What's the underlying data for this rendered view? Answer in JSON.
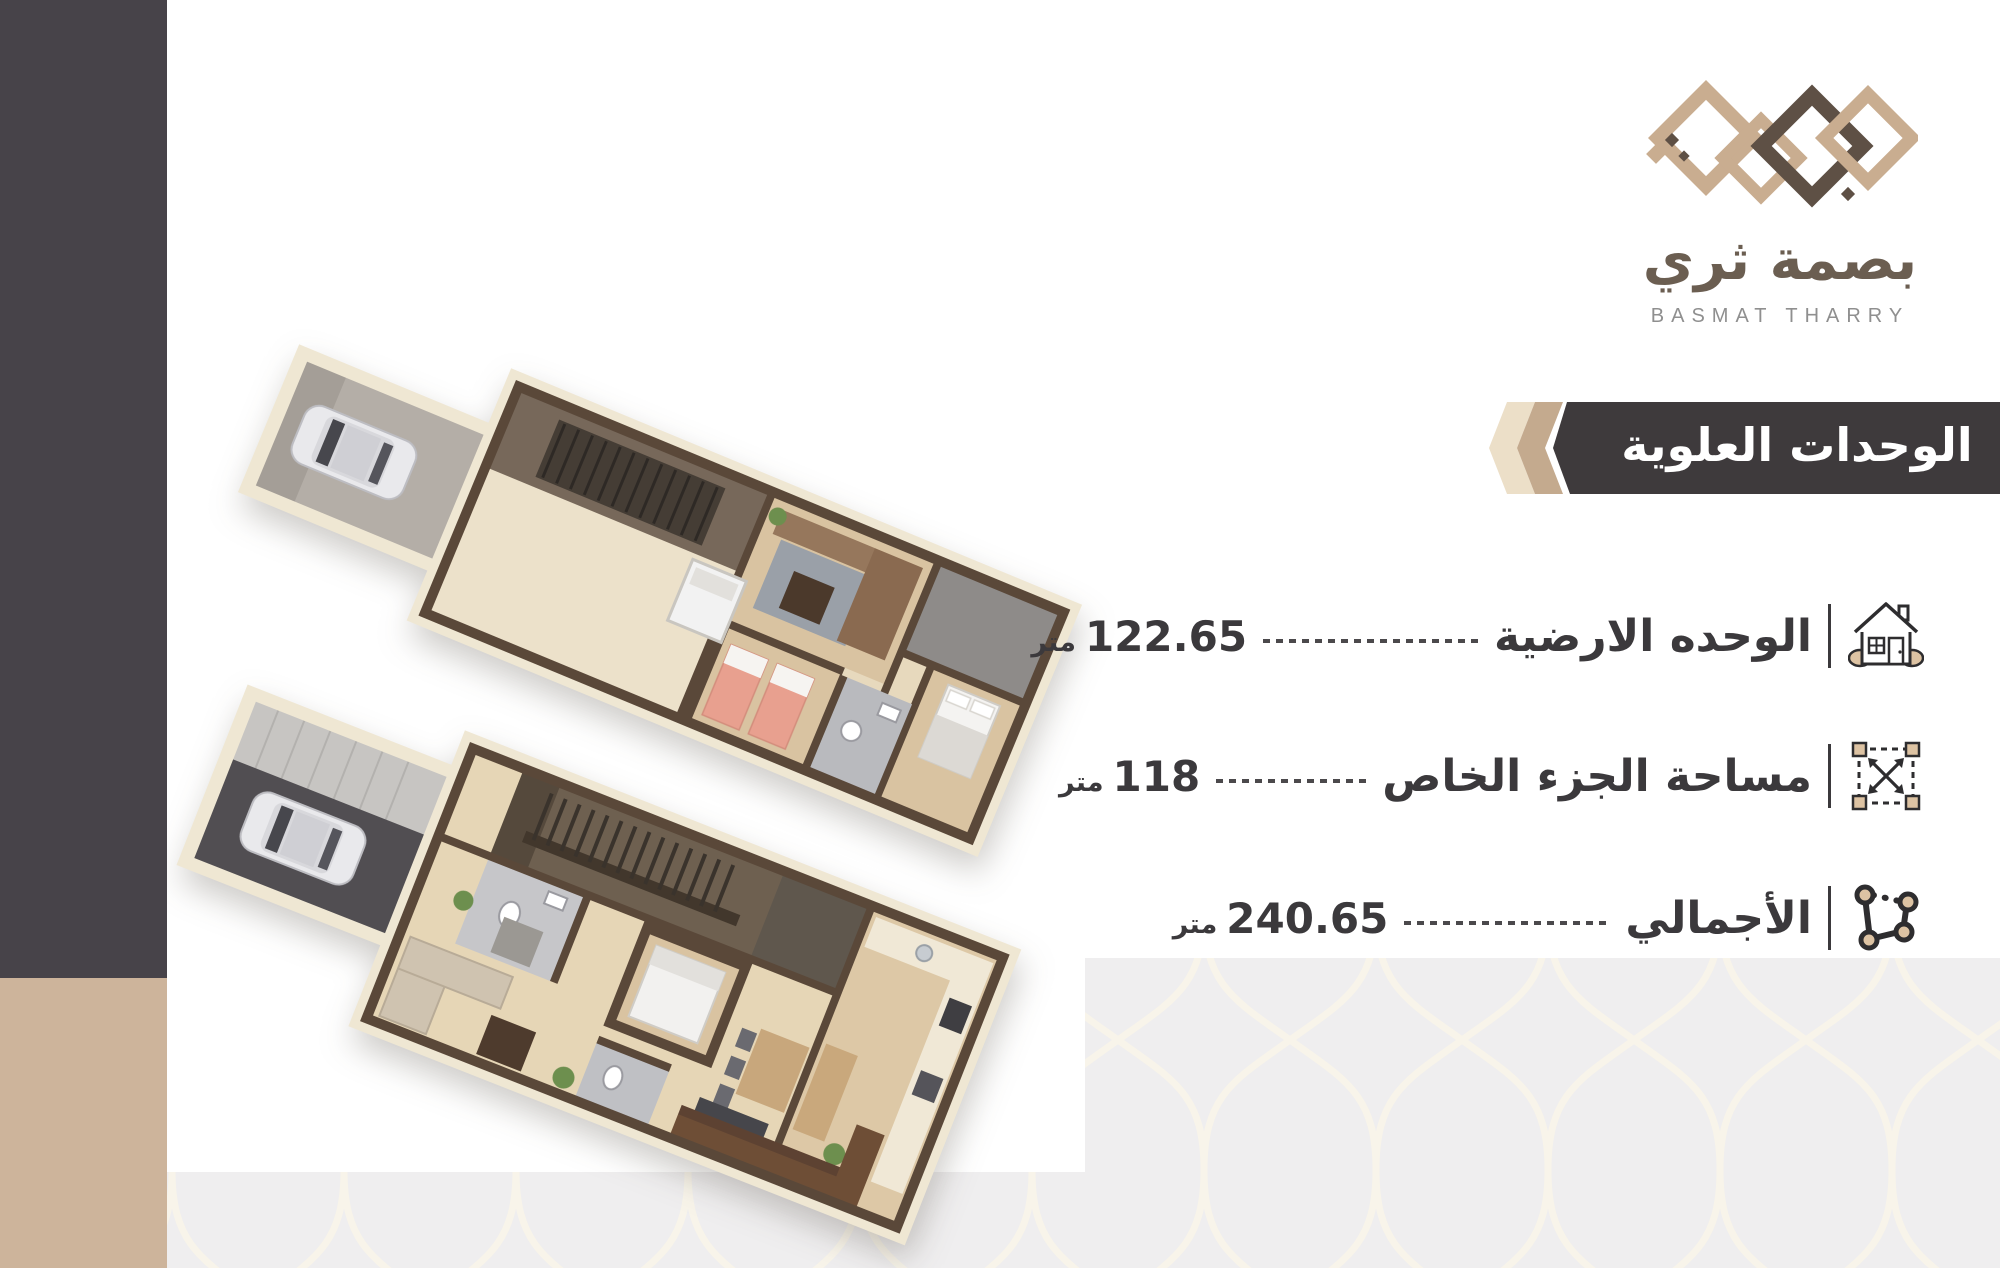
{
  "brand": {
    "name_arabic": "بصمة ثري",
    "name_latin": "BASMAT THARRY",
    "logo_colors": {
      "beige": "#c9ad90",
      "brown": "#5e5045"
    }
  },
  "banner": {
    "title": "الوحدات العلوية",
    "background": "#3e3a3c",
    "chevron_light": "#ecdfc8",
    "chevron_tan": "#c4aa8e"
  },
  "specs": [
    {
      "label": "الوحده الارضية",
      "value": "122.65",
      "unit": "متر",
      "icon": "house-icon"
    },
    {
      "label": "مساحة الجزء الخاص",
      "value": "118",
      "unit": "متر",
      "icon": "area-dimensions-icon"
    },
    {
      "label": "الأجمالي",
      "value": "240.65",
      "unit": "متر",
      "icon": "plot-polygon-icon"
    }
  ],
  "floor_plans": {
    "count": 2
  },
  "colors": {
    "sidebar_dark": "#474349",
    "sidebar_beige": "#cdb49b",
    "text_dark": "#3b393c",
    "pattern_bg": "#efeeef",
    "pattern_line": "#f8f4ea"
  }
}
